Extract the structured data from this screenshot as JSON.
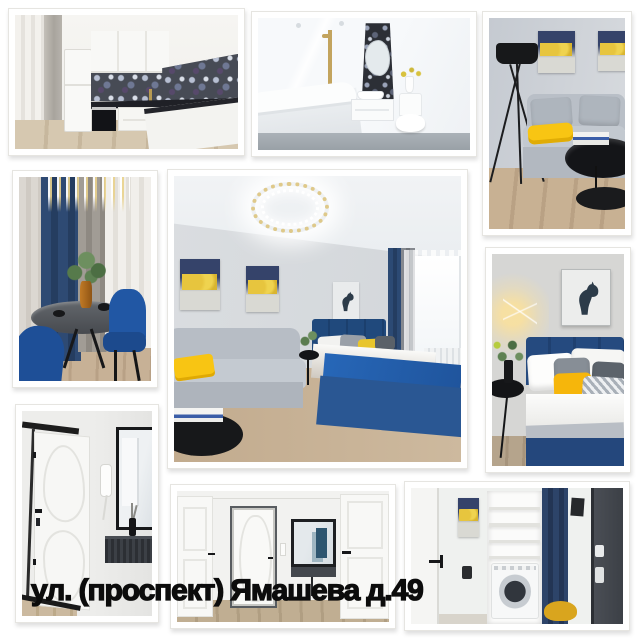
{
  "caption": {
    "text": "ул. (проспект) Ямашева д.49",
    "color": "#0c0c0c"
  },
  "collage": {
    "background": "#ffffff",
    "accent_colors": {
      "yellow": "#f8c513",
      "navy": "#24477c",
      "blue": "#2565b5",
      "light_gray": "#b9bfc7",
      "wood": "#c2ab8e"
    },
    "photos": [
      {
        "id": "kitchen",
        "label": "white kitchen with dark agate backsplash and fridge"
      },
      {
        "id": "bathroom",
        "label": "white bathroom with bathtub, blob mirror and gold shower"
      },
      {
        "id": "sofa",
        "label": "living corner with black tripod lamp, gray sofa and yellow throw"
      },
      {
        "id": "dining",
        "label": "dining nook with crystal chandelier, navy curtain and blue chairs"
      },
      {
        "id": "living",
        "label": "studio room with ring chandelier, gray sofa and blue bed"
      },
      {
        "id": "bedroom",
        "label": "bedroom with horse artwork, blue headboard and yellow pillows"
      },
      {
        "id": "entry",
        "label": "white entrance door with intercom, mirror and black console"
      },
      {
        "id": "hallway",
        "label": "hallway with white doors, entrance door and lit mirror"
      },
      {
        "id": "laundry",
        "label": "laundry niche with washing machine, shelves and navy curtain"
      }
    ]
  }
}
